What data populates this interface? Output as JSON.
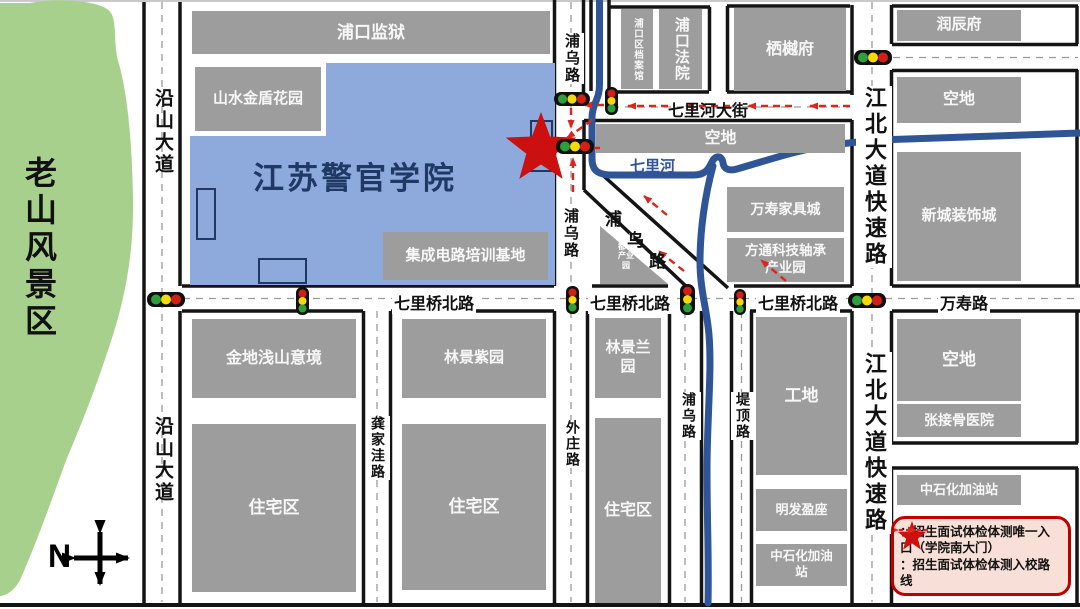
{
  "map": {
    "scenic_area": "老山风景区",
    "compass_north": "N"
  },
  "campus": {
    "title": "江苏警官学院",
    "prison": "浦口监狱",
    "garden": "山水金盾花园",
    "training_base": "集成电路培训基地"
  },
  "roads": {
    "yanshan": "沿山大道",
    "puwu": "浦乌路",
    "puwu_chars": [
      "浦",
      "乌",
      "路"
    ],
    "qilihe_street": "七里河大街",
    "qiliqiao_north": "七里桥北路",
    "wanshou": "万寿路",
    "jiangbei_express": "江北大道快速路",
    "gongjiawa": "龚家洼路",
    "waizhuang": "外庄路",
    "diding": "堤顶路"
  },
  "river": {
    "name": "七里河"
  },
  "blocks": {
    "archives": "浦口区档案馆",
    "court": "浦口法院",
    "qiyue_mansion": "栖樾府",
    "runchen_mansion": "润辰府",
    "vacant": "空地",
    "xincheng_deco": "新城装饰城",
    "wanshou_furniture": "万寿家具城",
    "fangtong_park": "方通科技轴承产业园",
    "dingshan_park": "顶山都市产业园",
    "jindi": "金地浅山意境",
    "linjing_purple": "林景紫园",
    "linjing_orchid": "林景兰园",
    "residential": "住宅区",
    "construction": "工地",
    "mingfa": "明发盈座",
    "sinopec": "中石化加油站",
    "zhang_hospital": "张接骨医院"
  },
  "legend": {
    "entry_star": "：招生面试体检体测唯一入口（学院南大门）",
    "entry_route": "：招生面试体检体测入校路线"
  },
  "colors": {
    "campus_blue": "#8EA9DB",
    "river_blue": "#2F5597",
    "route_red": "#D8281E",
    "block_gray": "#9D9D9D",
    "scenic_green": "#A8D08D",
    "title_navy": "#1F3864",
    "legend_bg": "#F8E0D8",
    "legend_border": "#C00000"
  }
}
